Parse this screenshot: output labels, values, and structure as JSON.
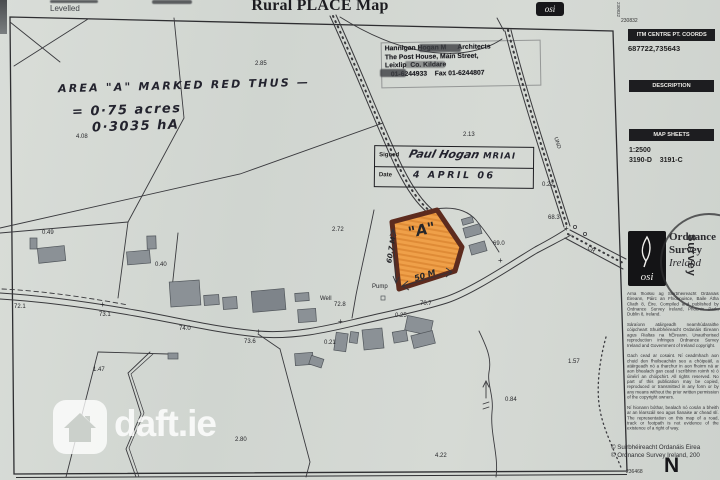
{
  "title": "Rural PLACE Map",
  "levelled": "Levelled",
  "watermark": {
    "brand": "daft.ie"
  },
  "osi_top_logo": "osi",
  "stamp": {
    "line1": "Hannigan Hogan M      Architects",
    "line2": "The Post House, Main Street,",
    "line3": "Leixlip  Co. Kildare",
    "line4": "   01-6244933    Fax 01-6244807"
  },
  "signed_box": {
    "signed_label": "Signed",
    "signature": "Paul Hogan",
    "credential": "MRIAI",
    "date_label": "Date",
    "date_value": "4 APRIL 06"
  },
  "annotations": {
    "area_note": "AREA \"A\" MARKED RED THUS —",
    "acres_line": "= 0·75 acres",
    "hectares_line": "0·3035 hA"
  },
  "plot": {
    "label": "\"A\"",
    "side_dim": "60.7 M",
    "bottom_dim": "50 M",
    "fill_color": "#efa049",
    "border_color": "#5d2b1e"
  },
  "sidebar": {
    "sheet_number_top": "230832",
    "sheet_number_vertical": "230832",
    "itm_header": "ITM CENTRE PT. COORDS",
    "itm_coords": "687722,735643",
    "description_header": "DESCRIPTION",
    "map_sheets_header": "MAP SHEETS",
    "scale": "1:2500",
    "sheets_line": "3190-D    3191-C",
    "osi_logo_text": "osi",
    "publisher_line1": "Ordnance",
    "publisher_line2": "Survey",
    "publisher_line3": "Ireland",
    "seal_word": "Survey",
    "smallprint": [
      "Arna fhoilsiú ag Suirbhéireacht Ordanáis Éireann, Páirc an Fhionnuisce, Baile Átha Cliath 8, Éire. Compiled and published by Ordnance Survey Ireland, Phoenix Park, Dublin 8, Ireland.",
      "Sáraíonn atáirgeadh neamhúdaraithe cóipcheart Shuirbhéireacht Ordanáis Éireann agus Rialtas na hÉireann. Unauthorised reproduction infringes Ordnance Survey Ireland and Government of Ireland copyright.",
      "Gach cead ar cosaint. Ní ceadmhach aon chuid den fhoilseachán seo a chóipeáil, a atáirgeadh nó a tharchur in aon fhoirm ná ar aon bhealach gan cead i scríbhinn roimh ré ó úinéirí an chóipchirt. All rights reserved. No part of this publication may be copied, reproduced or transmitted in any form or by any means without the prior written permission of the copyright owners.",
      "Ní hionann bóthar, bealach nó cosán a bheith ar an léarscáil seo agus fianaise ar chead slí. The representation on this map of a road, track or footpath is not evidence of the existence of a right of way."
    ],
    "copyright_line1": "© Suirbhéireacht Ordanáis Éirea",
    "copyright_line2": "© Ordnance Survey Ireland, 200",
    "sheet_number_bottom": "236468",
    "north": "N"
  },
  "map_labels": [
    {
      "t": "2.85",
      "x": 255,
      "y": 61
    },
    {
      "t": "2.13",
      "x": 463,
      "y": 132
    },
    {
      "t": "0.22",
      "x": 542,
      "y": 182
    },
    {
      "t": "2.72",
      "x": 332,
      "y": 227
    },
    {
      "t": "68.3",
      "x": 548,
      "y": 215
    },
    {
      "t": "69.0",
      "x": 493,
      "y": 241
    },
    {
      "t": "0.49",
      "x": 42,
      "y": 230
    },
    {
      "t": "0.40",
      "x": 155,
      "y": 262
    },
    {
      "t": "72.1",
      "x": 14,
      "y": 304
    },
    {
      "t": "73.1",
      "x": 99,
      "y": 312
    },
    {
      "t": "74.0",
      "x": 179,
      "y": 326
    },
    {
      "t": "73.6",
      "x": 244,
      "y": 339
    },
    {
      "t": "Well",
      "x": 320,
      "y": 296
    },
    {
      "t": "72.8",
      "x": 334,
      "y": 302
    },
    {
      "t": "Pump",
      "x": 372,
      "y": 284
    },
    {
      "t": "0.25",
      "x": 395,
      "y": 313
    },
    {
      "t": "0.21",
      "x": 324,
      "y": 340
    },
    {
      "t": "70.7",
      "x": 420,
      "y": 301
    },
    {
      "t": "1.47",
      "x": 93,
      "y": 367
    },
    {
      "t": "2.80",
      "x": 235,
      "y": 437
    },
    {
      "t": "4.22",
      "x": 435,
      "y": 453
    },
    {
      "t": "0.84",
      "x": 505,
      "y": 397
    },
    {
      "t": "1.57",
      "x": 568,
      "y": 359
    },
    {
      "t": "4.08",
      "x": 76,
      "y": 134
    },
    {
      "t": "UND",
      "x": 551,
      "y": 140,
      "rot": 73,
      "size": 5.5
    },
    {
      "t": "CR",
      "x": 587,
      "y": 247,
      "rot": 28,
      "size": 5.5
    },
    {
      "t": "+",
      "x": 100,
      "y": 300,
      "size": 8
    },
    {
      "t": "+",
      "x": 256,
      "y": 327,
      "size": 8
    },
    {
      "t": "+",
      "x": 338,
      "y": 317,
      "size": 8
    },
    {
      "t": "+",
      "x": 498,
      "y": 256,
      "size": 8
    },
    {
      "t": "+",
      "x": 564,
      "y": 224,
      "size": 8
    },
    {
      "t": "\"A\"",
      "x": 408,
      "y": 221,
      "rot": -12,
      "size": 15,
      "hw": 1
    },
    {
      "t": "60.7 M",
      "x": 378,
      "y": 246,
      "rot": -81,
      "size": 7,
      "hw": 1
    },
    {
      "t": "50 M",
      "x": 414,
      "y": 271,
      "rot": -17,
      "size": 8,
      "hw": 1
    }
  ]
}
